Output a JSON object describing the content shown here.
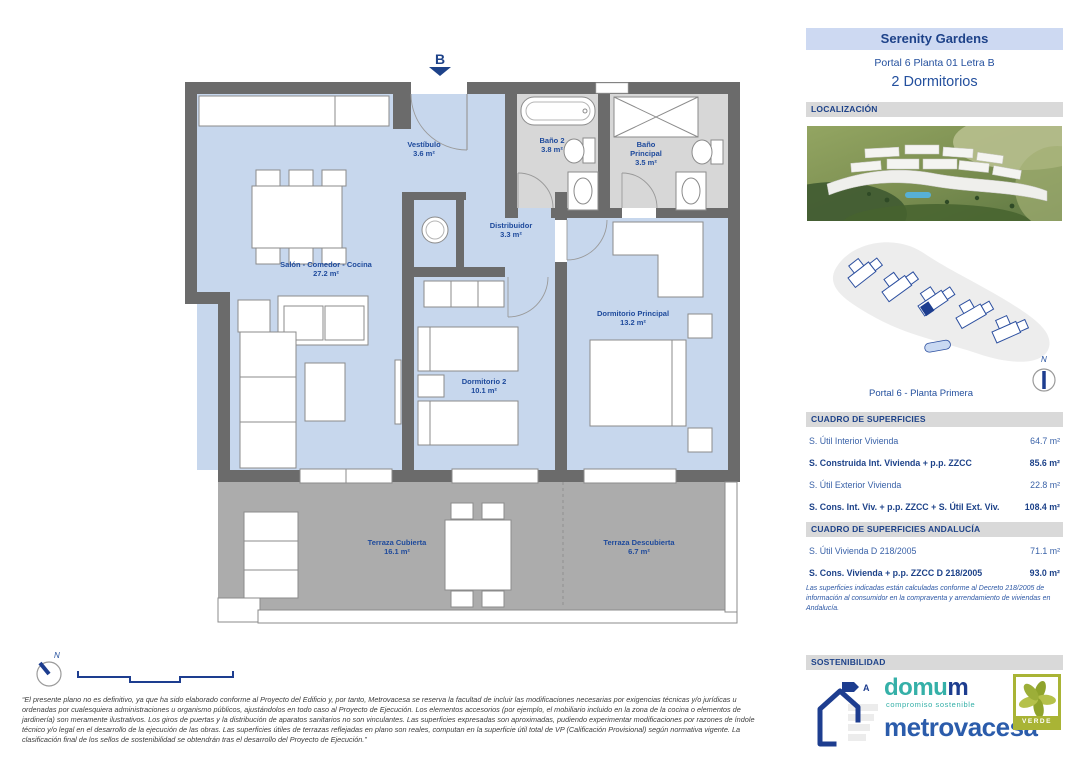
{
  "colors": {
    "navy": "#1d4289",
    "teal": "#35b0a8",
    "olive": "#a9b435",
    "band_blue": "#cdd9f2",
    "band_gray": "#d9d9d9"
  },
  "header": {
    "title": "Serenity Gardens",
    "unit": "Portal 6 Planta 01 Letra B",
    "bedrooms": "2 Dormitorios"
  },
  "location": {
    "section": "LOCALIZACIÓN",
    "caption": "Portal 6 - Planta Primera",
    "north": "N"
  },
  "surfaces": {
    "section": "CUADRO DE SUPERFICIES",
    "rows": [
      {
        "label": "S. Útil Interior Vivienda",
        "value": "64.7 m²"
      },
      {
        "label": "S. Construida Int. Vivienda + p.p. ZZCC",
        "value": "85.6 m²"
      },
      {
        "label": "S. Útil Exterior Vivienda",
        "value": "22.8 m²"
      },
      {
        "label": "S. Cons. Int. Viv. + p.p. ZZCC + S. Útil Ext. Viv.",
        "value": "108.4 m²"
      }
    ]
  },
  "andalucia": {
    "section": "CUADRO DE SUPERFICIES ANDALUCÍA",
    "rows": [
      {
        "label": "S. Útil Vivienda D 218/2005",
        "value": "71.1 m²"
      },
      {
        "label": "S. Cons. Vivienda + p.p. ZZCC D 218/2005",
        "value": "93.0 m²"
      }
    ],
    "note": "Las superficies indicadas están calculadas conforme al Decreto 218/2005 de información al consumidor en la compraventa y arrendamiento de viviendas en Andalucía."
  },
  "sustainability": {
    "section": "SOSTENIBILIDAD",
    "energy_letter": "A",
    "domum_part1": "domu",
    "domum_part2": "m",
    "tagline": "compromiso sostenible",
    "brand": "metrovacesa",
    "verde_label": "VERDE"
  },
  "plan": {
    "entrance": "B",
    "north": "N",
    "rooms": [
      {
        "name": "Vestíbulo",
        "area": "3.6 m²"
      },
      {
        "name": "Baño 2",
        "area": "3.8 m²"
      },
      {
        "name": "Baño Principal",
        "area": "3.5 m²"
      },
      {
        "name": "Distribuidor",
        "area": "3.3 m²"
      },
      {
        "name": "Salón - Comedor - Cocina",
        "area": "27.2 m²"
      },
      {
        "name": "Dormitorio 2",
        "area": "10.1 m²"
      },
      {
        "name": "Dormitorio Principal",
        "area": "13.2 m²"
      },
      {
        "name": "Terraza Cubierta",
        "area": "16.1 m²"
      },
      {
        "name": "Terraza Descubierta",
        "area": "6.7 m²"
      }
    ]
  },
  "disclaimer": "“El presente plano no es definitivo, ya que ha sido elaborado conforme al Proyecto del Edificio y, por tanto, Metrovacesa se reserva la facultad de incluir las modificaciones necesarias por exigencias técnicas y/o jurídicas u ordenadas por cualesquiera administraciones u organismo públicos, ajustándolos en todo caso al Proyecto de Ejecución. Los elementos accesorios (por ejemplo, el mobiliario incluido en la zona de la cocina o elementos de jardinería) son meramente ilustrativos. Los giros de puertas y la distribución de aparatos sanitarios no son vinculantes. Las superficies expresadas son aproximadas, pudiendo experimentar modificaciones por razones de índole técnico y/o legal en el desarrollo de la ejecución de las obras. Las superficies útiles de terrazas reflejadas en plano son reales, computan en la superficie útil total de VP (Calificación Provisional) según normativa vigente. La clasificación final de los sellos de sostenibilidad se obtendrán tras el desarrollo del Proyecto de Ejecución.”"
}
